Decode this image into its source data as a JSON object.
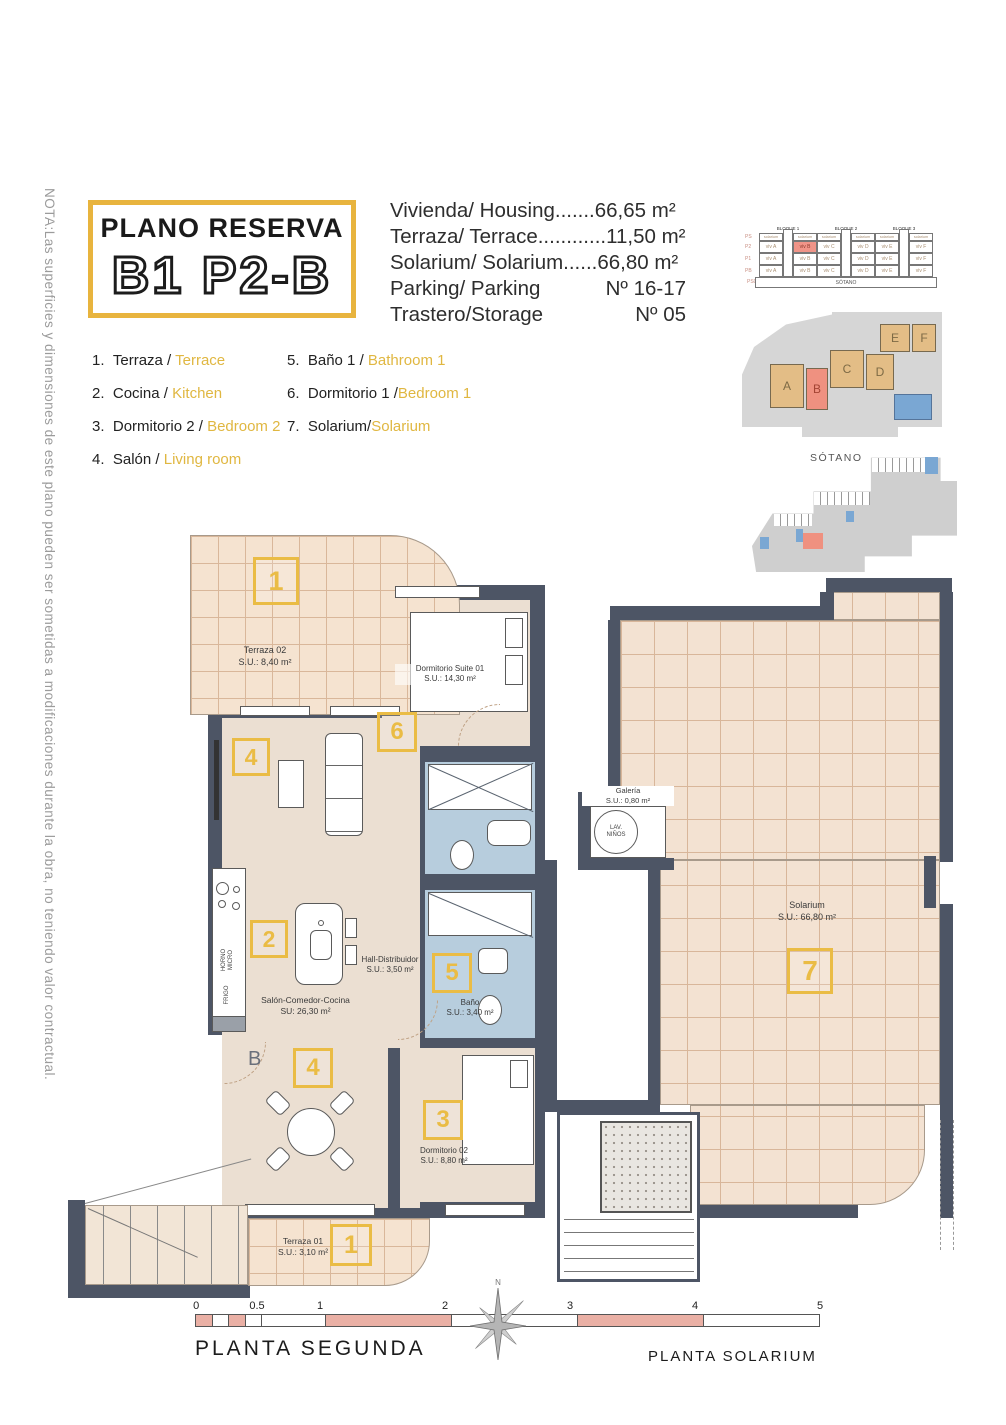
{
  "note": "NOTA:Las superficies y dimensiones de este plano pueden ser sometidas a modificaciones durante la obra, no teniendo valor contractual.",
  "title": {
    "line1": "PLANO RESERVA",
    "line2": "B1 P2-B"
  },
  "specs": [
    {
      "label": "Vivienda/ Housing.......",
      "value": "66,65 m²"
    },
    {
      "label": "Terraza/ Terrace............",
      "value": "11,50 m²"
    },
    {
      "label": "Solarium/ Solarium......",
      "value": "66,80 m²"
    },
    {
      "label": "Parking/ Parking",
      "value": "Nº 16-17"
    },
    {
      "label": "Trastero/Storage",
      "value": "Nº 05"
    }
  ],
  "legend": [
    {
      "num": "1.",
      "es": "Terraza / ",
      "en": "Terrace"
    },
    {
      "num": "2.",
      "es": "Cocina / ",
      "en": "Kitchen"
    },
    {
      "num": "3.",
      "es": "Dormitorio 2 / ",
      "en": "Bedroom 2"
    },
    {
      "num": "4.",
      "es": "Salón / ",
      "en": "Living room"
    },
    {
      "num": "5.",
      "es": "Baño 1 / ",
      "en": "Bathroom 1"
    },
    {
      "num": "6.",
      "es": "Dormitorio 1 /",
      "en": "Bedroom 1"
    },
    {
      "num": "7.",
      "es": "Solarium/",
      "en": "Solarium"
    }
  ],
  "sec": {
    "blocks": [
      "BLOQUE 1",
      "BLOQUE 2",
      "BLOQUE 3"
    ],
    "floors": [
      "PS",
      "P2",
      "P1",
      "PB",
      "PS0"
    ],
    "sol": "solarium",
    "units": [
      "viv A",
      "viv B",
      "viv C",
      "viv D",
      "viv E",
      "viv F"
    ],
    "sotano": "SÓTANO"
  },
  "site": {
    "letters": [
      "A",
      "B",
      "C",
      "D",
      "E",
      "F"
    ]
  },
  "sot": {
    "label": "SÓTANO"
  },
  "p2": {
    "title": "PLANTA SEGUNDA",
    "terraza02": {
      "n": "1",
      "name": "Terraza 02",
      "area": "S.U.: 8,40 m²"
    },
    "suite": {
      "n": "6",
      "name": "Dormitorio Suite 01",
      "area": "S.U.: 14,30 m²"
    },
    "salon": {
      "n": "4",
      "name": "Salón-Comedor-Cocina",
      "area": "SU: 26,30 m²"
    },
    "cocina": {
      "n": "2"
    },
    "hall": {
      "name": "Hall-Distribuidor",
      "area": "S.U.: 3,50 m²"
    },
    "bano": {
      "n": "5",
      "name": "Baño",
      "area": "S.U.: 3,40 m²"
    },
    "dorm02": {
      "n": "3",
      "name": "Dormitorio 02",
      "area": "S.U.: 8,80 m²"
    },
    "terraza01": {
      "n": "1",
      "name": "Terraza 01",
      "area": "S.U.: 3,10 m²"
    },
    "comedor": {
      "n": "4"
    },
    "horno": "HORNO",
    "micro": "MICRO",
    "frigo": "FRIGO",
    "entry": "B"
  },
  "ps": {
    "title": "PLANTA SOLARIUM",
    "galeria": {
      "name": "Galería",
      "area": "S.U.: 0,80 m²",
      "lav1": "LAV.",
      "lav2": "NIÑOS"
    },
    "solarium": {
      "n": "7",
      "name": "Solarium",
      "area": "S.U.: 66,80 m²"
    }
  },
  "scale": {
    "ticks": [
      "0",
      "0.5",
      "1",
      "2",
      "3",
      "4",
      "5"
    ]
  },
  "compass": "N"
}
